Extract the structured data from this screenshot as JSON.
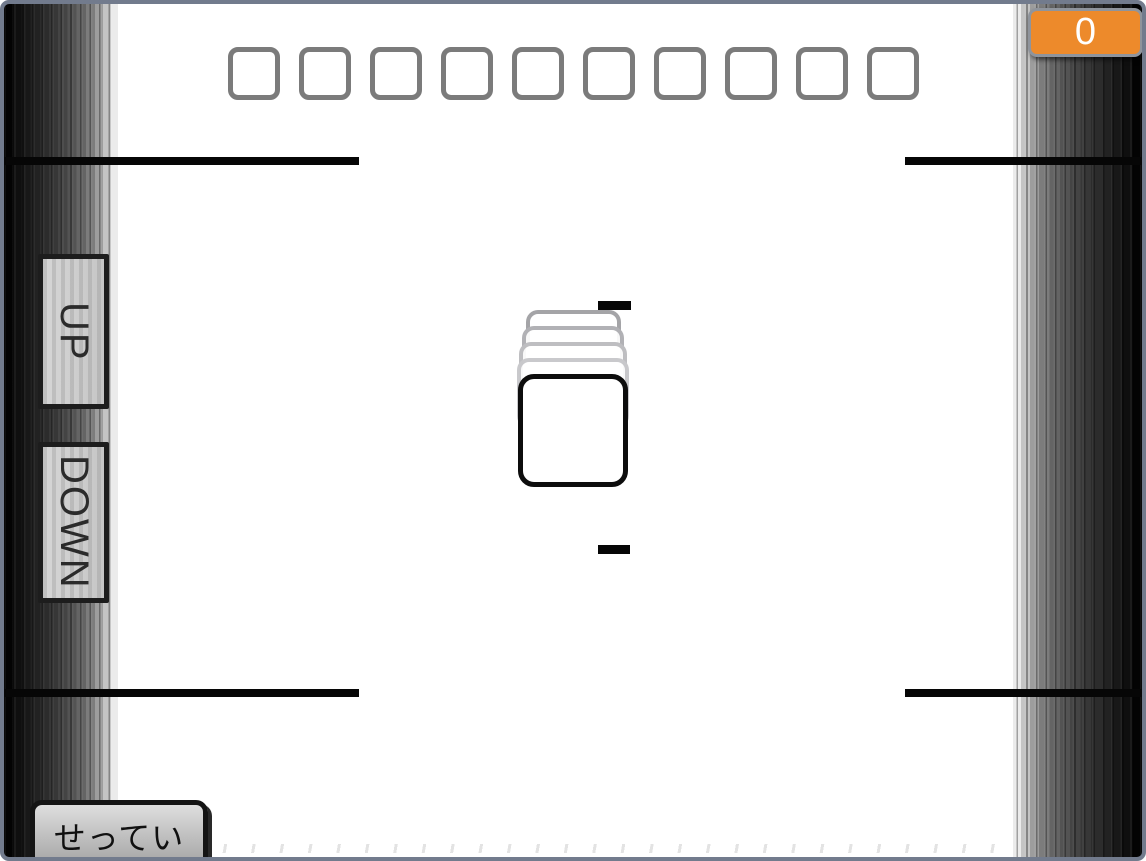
{
  "score": {
    "value": "0"
  },
  "slots": {
    "count": 10
  },
  "controls": {
    "up_label": "UP",
    "down_label": "DOWN"
  },
  "settings": {
    "label": "せってい"
  },
  "colors": {
    "accent_orange": "#ED8A2B",
    "frame_blue_gray": "#727B8D",
    "line_black": "#060606",
    "slot_border_gray": "#7B7B7B"
  }
}
